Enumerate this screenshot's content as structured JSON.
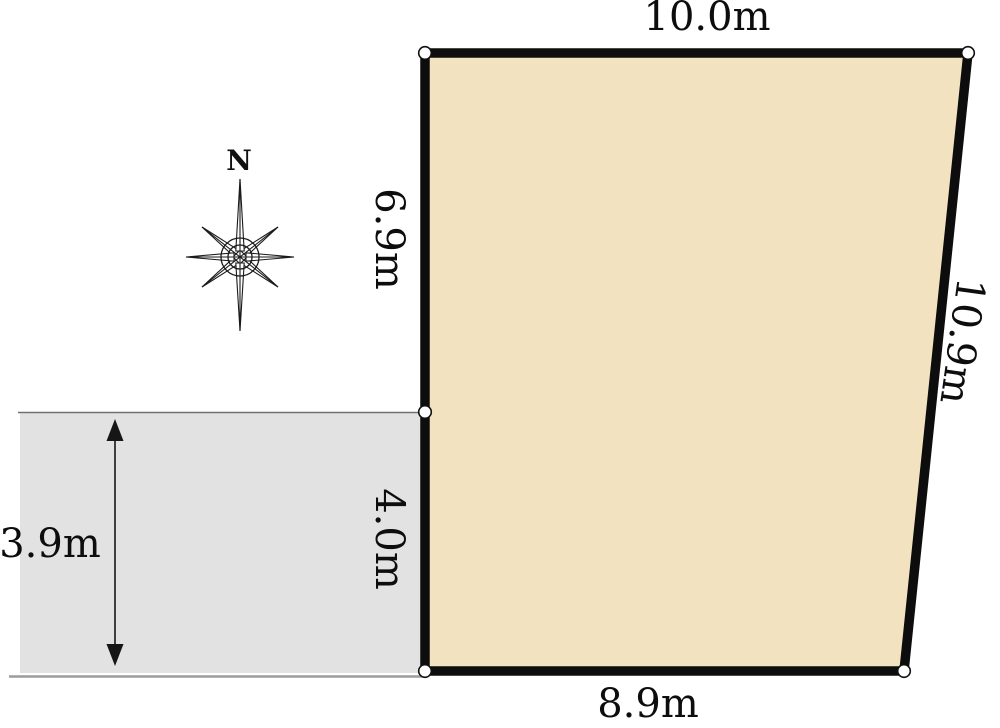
{
  "lot": {
    "points": "425,53 968,53 904,671 425,671",
    "fill_color": "#f2e2c0",
    "stroke_color": "#0d0d0d",
    "dimensions": {
      "top": "10.0m",
      "right": "10.9m",
      "bottom": "8.9m",
      "left_upper": "6.9m",
      "left_lower": "4.0m"
    }
  },
  "road": {
    "fill_color": "#e2e2e2",
    "top_edge_color": "#707070",
    "bottom_edge_color": "#9c9c9c",
    "width_dimension": "3.9m"
  },
  "compass": {
    "north_label": "N"
  }
}
